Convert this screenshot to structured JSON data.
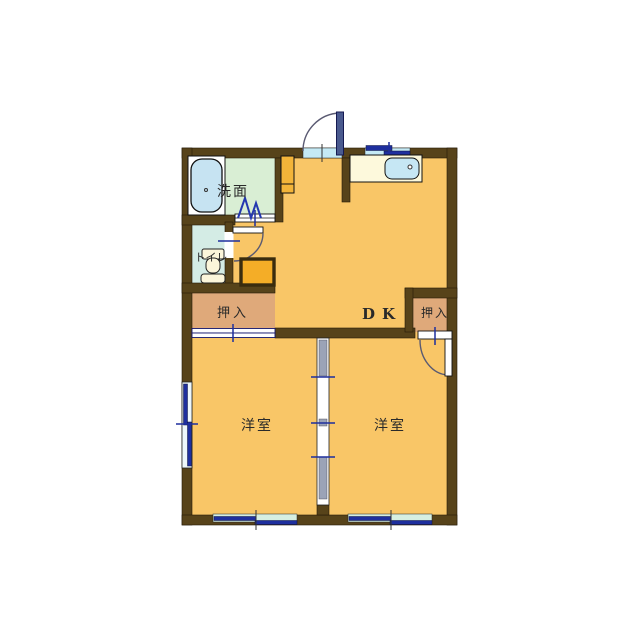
{
  "floorplan": {
    "type": "apartment-floor-plan",
    "labels": {
      "washroom": "洗面",
      "toilet": "トイレ",
      "closet_left": "押入",
      "closet_right": "押入",
      "dining_kitchen": "DK",
      "bedroom_left": "洋室",
      "bedroom_right": "洋室"
    },
    "colors": {
      "wall": "#57431a",
      "floor": "#f9c667",
      "closet": "#dfa97a",
      "washroom": "#d9eed4",
      "toilet": "#d4ece5",
      "bathtub": "#c6e3f2",
      "sink": "#c6e7f4",
      "counter": "#fdf9dc",
      "window_frame": "#1e2f9e",
      "window_glass": "#c5eaf5",
      "fixture_orange": "#f4ad27",
      "cabinet_orange": "#f3b439",
      "door_panel": "#4a5a8e"
    }
  }
}
